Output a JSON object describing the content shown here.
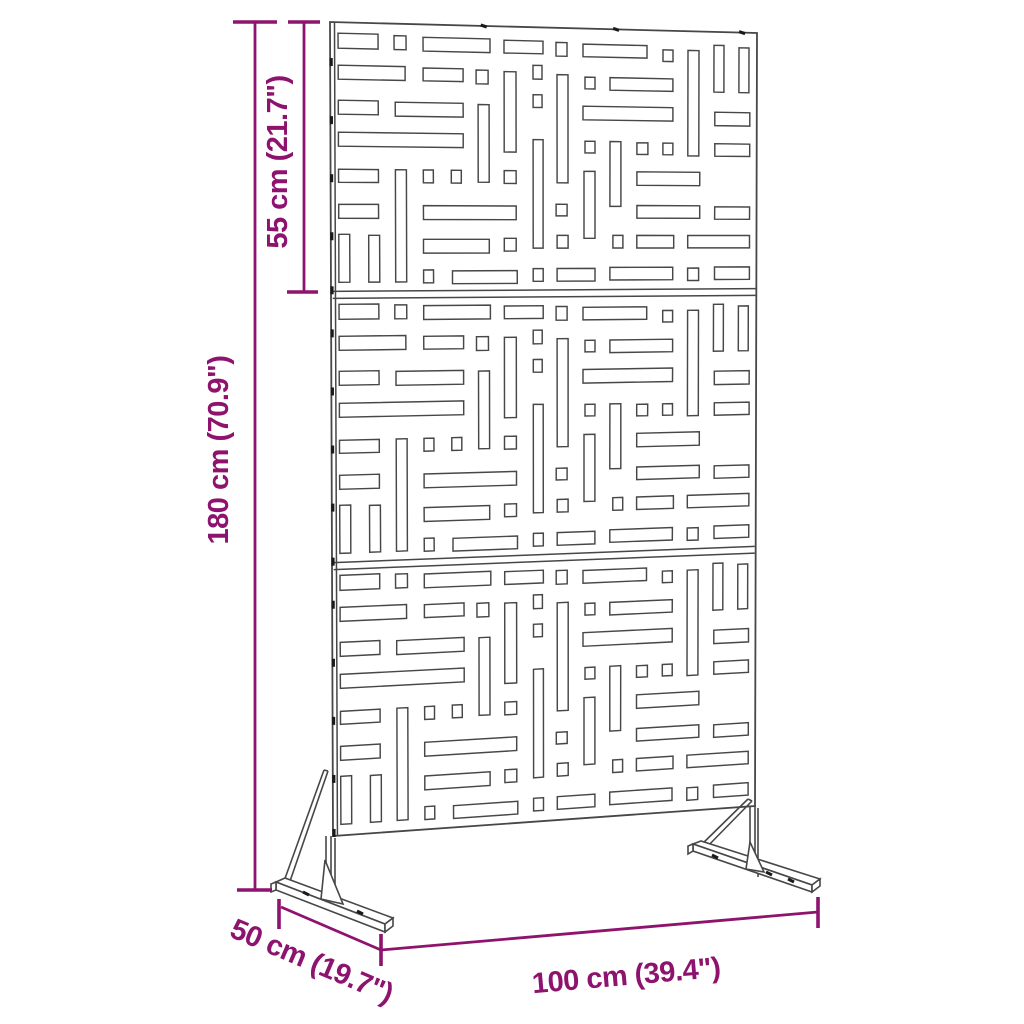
{
  "page": {
    "title": "Garden privacy screen with stand - dimension diagram",
    "background": "#FFFFFF"
  },
  "colors": {
    "dimension_accent": "#8E136E",
    "drawing_line": "#474747",
    "tab_mark": "#1A1A1A",
    "panel_fill": "#FFFFFF"
  },
  "dimensions": {
    "total_height": {
      "label": "180 cm (70.9\")"
    },
    "section_height": {
      "label": "55 cm (21.7\")"
    },
    "width": {
      "label": "100 cm (39.4\")"
    },
    "depth": {
      "label": "50 cm (19.7\")"
    }
  },
  "diagram": {
    "panel": {
      "quad": [
        [
          330,
          22
        ],
        [
          757,
          33
        ],
        [
          755,
          806
        ],
        [
          333,
          836
        ]
      ],
      "sections": 3,
      "local_width": 427,
      "local_section_height": 271,
      "inner_edge_u": 0.0105
    },
    "slots": [
      [
        8,
        11,
        40,
        15
      ],
      [
        64,
        12,
        12,
        14
      ],
      [
        93,
        13,
        67,
        14
      ],
      [
        174,
        14,
        39,
        13
      ],
      [
        226,
        15,
        11,
        14
      ],
      [
        253,
        16,
        64,
        13
      ],
      [
        333,
        20,
        10,
        12
      ],
      [
        358,
        20,
        11,
        110
      ],
      [
        384,
        14,
        10,
        49
      ],
      [
        409,
        16,
        10,
        47
      ],
      [
        8,
        43,
        67,
        14
      ],
      [
        93,
        44,
        40,
        13
      ],
      [
        146,
        45,
        12,
        14
      ],
      [
        174,
        46,
        12,
        82
      ],
      [
        203,
        39,
        9,
        14
      ],
      [
        227,
        48,
        11,
        111
      ],
      [
        255,
        50,
        10,
        12
      ],
      [
        280,
        50,
        63,
        13
      ],
      [
        385,
        84,
        35,
        14
      ],
      [
        8,
        78,
        40,
        14
      ],
      [
        65,
        79,
        68,
        14
      ],
      [
        148,
        80,
        11,
        79
      ],
      [
        203,
        69,
        9,
        13
      ],
      [
        253,
        80,
        90,
        14
      ],
      [
        8,
        110,
        125,
        14
      ],
      [
        203,
        115,
        10,
        111
      ],
      [
        255,
        116,
        10,
        12
      ],
      [
        280,
        116,
        11,
        67
      ],
      [
        307,
        117,
        11,
        12
      ],
      [
        333,
        117,
        10,
        12
      ],
      [
        385,
        117,
        35,
        13
      ],
      [
        8,
        147,
        40,
        13
      ],
      [
        65,
        147,
        11,
        113
      ],
      [
        93,
        147,
        10,
        13
      ],
      [
        121,
        147,
        10,
        13
      ],
      [
        174,
        147,
        12,
        13
      ],
      [
        254,
        147,
        11,
        69
      ],
      [
        307,
        147,
        63,
        14
      ],
      [
        8,
        182,
        40,
        14
      ],
      [
        93,
        183,
        93,
        14
      ],
      [
        226,
        181,
        11,
        12
      ],
      [
        307,
        182,
        63,
        13
      ],
      [
        385,
        183,
        35,
        13
      ],
      [
        8,
        212,
        11,
        48
      ],
      [
        38,
        213,
        11,
        47
      ],
      [
        93,
        217,
        66,
        14
      ],
      [
        174,
        216,
        12,
        13
      ],
      [
        227,
        213,
        11,
        13
      ],
      [
        283,
        213,
        10,
        13
      ],
      [
        307,
        213,
        37,
        13
      ],
      [
        358,
        213,
        62,
        13
      ],
      [
        93,
        248,
        10,
        13
      ],
      [
        122,
        249,
        65,
        13
      ],
      [
        203,
        247,
        10,
        13
      ],
      [
        227,
        247,
        38,
        13
      ],
      [
        280,
        246,
        63,
        13
      ],
      [
        358,
        247,
        11,
        13
      ],
      [
        385,
        246,
        35,
        13
      ]
    ],
    "left_edge_tabs_local_v": [
      40,
      98,
      156,
      214,
      268
    ],
    "top_edge_marks_u": [
      0.36,
      0.67,
      0.965
    ],
    "feet": {
      "polys": [
        [
          [
            276,
            882
          ],
          [
            285,
            878
          ],
          [
            393,
            918
          ],
          [
            385,
            924
          ]
        ],
        [
          [
            276,
            882
          ],
          [
            385,
            924
          ],
          [
            385,
            932
          ],
          [
            276,
            890
          ]
        ],
        [
          [
            385,
            924
          ],
          [
            393,
            918
          ],
          [
            393,
            926
          ],
          [
            385,
            932
          ]
        ],
        [
          [
            276,
            882
          ],
          [
            271,
            884
          ],
          [
            271,
            892
          ],
          [
            276,
            890
          ]
        ],
        [
          [
            325,
            860
          ],
          [
            321,
            899
          ],
          [
            343,
            904
          ]
        ],
        [
          [
            693,
            844
          ],
          [
            701,
            841
          ],
          [
            820,
            879
          ],
          [
            812,
            885
          ]
        ],
        [
          [
            693,
            844
          ],
          [
            812,
            885
          ],
          [
            812,
            892
          ],
          [
            693,
            851
          ]
        ],
        [
          [
            812,
            885
          ],
          [
            820,
            879
          ],
          [
            820,
            886
          ],
          [
            812,
            892
          ]
        ],
        [
          [
            693,
            844
          ],
          [
            688,
            846
          ],
          [
            688,
            854
          ],
          [
            693,
            851
          ]
        ],
        [
          [
            750,
            842
          ],
          [
            746,
            869
          ],
          [
            764,
            872
          ]
        ]
      ],
      "lines": [
        [
          326,
          836,
          326,
          884
        ],
        [
          331,
          836,
          331,
          886
        ],
        [
          335,
          838,
          335,
          904
        ],
        [
          324,
          770,
          283,
          884
        ],
        [
          328,
          771,
          288,
          887
        ],
        [
          324,
          770,
          328,
          771
        ],
        [
          750,
          806,
          750,
          865
        ],
        [
          755,
          806,
          755,
          867
        ],
        [
          758,
          808,
          758,
          877
        ],
        [
          748,
          799,
          697,
          849
        ],
        [
          752,
          801,
          701,
          853
        ],
        [
          748,
          799,
          752,
          801
        ]
      ],
      "dots": [
        [
          303,
          892,
          309,
          895
        ],
        [
          357,
          911,
          363,
          914
        ],
        [
          712,
          855,
          718,
          858
        ],
        [
          766,
          872,
          772,
          875
        ],
        [
          788,
          879,
          794,
          882
        ]
      ]
    },
    "dim_lines": [
      [
        255,
        22,
        255,
        890,
        2.8
      ],
      [
        233,
        22,
        277,
        22,
        3.6
      ],
      [
        237,
        890,
        272,
        890,
        3.6
      ],
      [
        304,
        22,
        304,
        292,
        2.8
      ],
      [
        288,
        22,
        320,
        22,
        3.6
      ],
      [
        287,
        292,
        318,
        292,
        3.6
      ],
      [
        381,
        950,
        818,
        912,
        2.8
      ],
      [
        381,
        934,
        381,
        966,
        3.6
      ],
      [
        818,
        897,
        818,
        928,
        3.6
      ],
      [
        281,
        907,
        381,
        950,
        2.8
      ],
      [
        279,
        899,
        279,
        929,
        3.6
      ]
    ]
  }
}
